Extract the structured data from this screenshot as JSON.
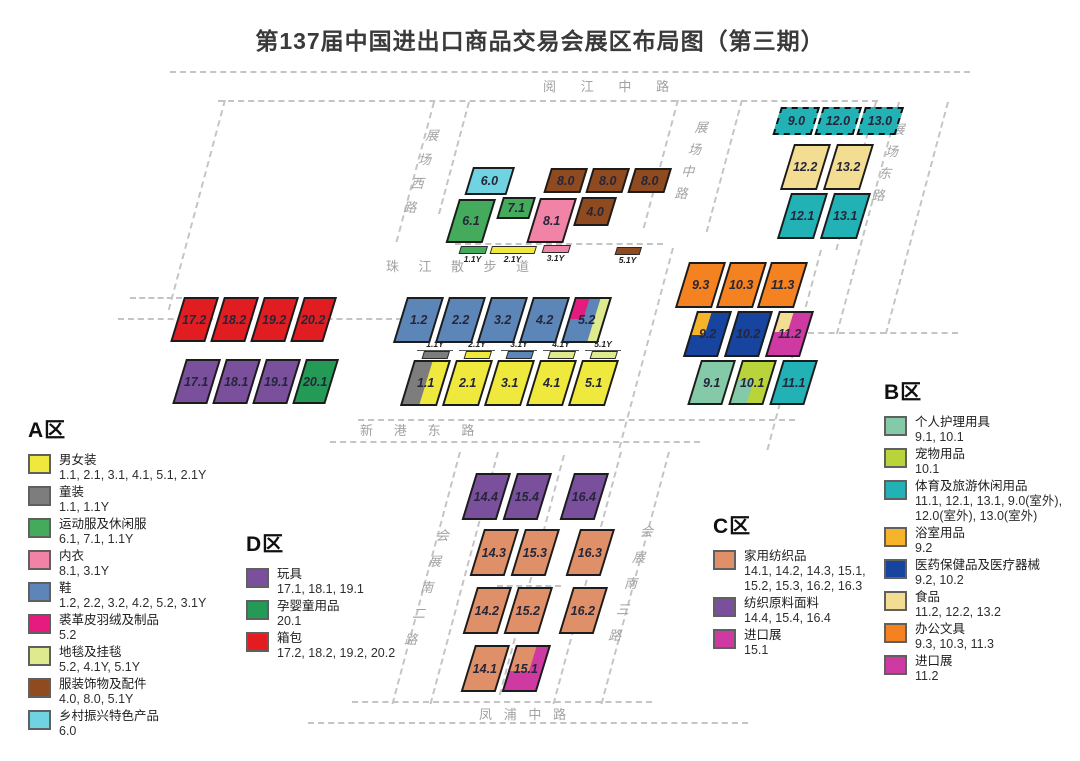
{
  "title": "第137届中国进出口商品交易会展区布局图（第三期）",
  "colors": {
    "yellow": "#efe93e",
    "gray": "#7d7d7d",
    "green": "#44ab5c",
    "pink": "#f083a6",
    "blue": "#5d86b8",
    "magentaA": "#e31c7e",
    "lightlime": "#dfe98d",
    "brown": "#8f4a1f",
    "cyan": "#6fd3e2",
    "purple": "#7a4f9c",
    "greenD": "#239a55",
    "red": "#e21d21",
    "salmon": "#df9069",
    "magentaC": "#ce3aa2",
    "mint": "#84c9a8",
    "lime": "#b9d43a",
    "teal": "#22b1b5",
    "amber": "#f6b42a",
    "navy": "#16449f",
    "cream": "#f2dd92",
    "orange": "#f58220"
  },
  "map": {
    "roads": [
      {
        "id": "yuejiang",
        "label": "阅江中路"
      },
      {
        "id": "zhanchang_xi",
        "label": "展场西路"
      },
      {
        "id": "zhanchang_zhong",
        "label": "展场中路"
      },
      {
        "id": "zhanchang_dong",
        "label": "展场东路"
      },
      {
        "id": "zhujiang",
        "label": "珠江散步道"
      },
      {
        "id": "xingang",
        "label": "新港东路"
      },
      {
        "id": "huizhan_nan_er",
        "label": "会展南二路"
      },
      {
        "id": "huizhan_nan_san",
        "label": "会展南三路"
      },
      {
        "id": "fengpu",
        "label": "凤浦中路"
      }
    ],
    "halls": [
      {
        "label": "6.0",
        "c": "cyan",
        "x": 473,
        "y": 167,
        "w": 42,
        "h": 28
      },
      {
        "label": "8.0",
        "c": "brown",
        "x": 551,
        "y": 168,
        "w": 37,
        "h": 25
      },
      {
        "label": "8.0",
        "c": "brown",
        "x": 593,
        "y": 168,
        "w": 37,
        "h": 25
      },
      {
        "label": "8.0",
        "c": "brown",
        "x": 635,
        "y": 168,
        "w": 37,
        "h": 25
      },
      {
        "label": "6.1",
        "c": "green",
        "x": 459,
        "y": 199,
        "w": 37,
        "h": 44
      },
      {
        "label": "7.1",
        "c": "green",
        "x": 503,
        "y": 197,
        "w": 33,
        "h": 22
      },
      {
        "label": "8.1",
        "c": "pink",
        "x": 540,
        "y": 198,
        "w": 37,
        "h": 45
      },
      {
        "label": "4.0",
        "c": "brown",
        "x": 582,
        "y": 197,
        "w": 35,
        "h": 29
      },
      {
        "label": "1.1Y",
        "c": "green",
        "x": 461,
        "y": 246,
        "w": 27,
        "h": 8,
        "bar": "below"
      },
      {
        "label": "2.1Y",
        "c": "yellow",
        "x": 492,
        "y": 246,
        "w": 45,
        "h": 8,
        "bar": "below"
      },
      {
        "label": "3.1Y",
        "c": "pink",
        "x": 544,
        "y": 245,
        "w": 27,
        "h": 8,
        "bar": "below"
      },
      {
        "label": "5.1Y",
        "c": "brown",
        "x": 617,
        "y": 247,
        "w": 25,
        "h": 8,
        "bar": "below"
      },
      {
        "label": "9.0",
        "c": "teal",
        "x": 781,
        "y": 107,
        "w": 39,
        "h": 28,
        "dashed": true
      },
      {
        "label": "12.0",
        "c": "teal",
        "x": 823,
        "y": 107,
        "w": 39,
        "h": 28,
        "dashed": true
      },
      {
        "label": "13.0",
        "c": "teal",
        "x": 865,
        "y": 107,
        "w": 39,
        "h": 28,
        "dashed": true
      },
      {
        "label": "12.2",
        "c": "cream",
        "x": 794,
        "y": 144,
        "w": 37,
        "h": 46
      },
      {
        "label": "13.2",
        "c": "cream",
        "x": 837,
        "y": 144,
        "w": 37,
        "h": 46
      },
      {
        "label": "12.1",
        "c": "teal",
        "x": 791,
        "y": 193,
        "w": 37,
        "h": 46
      },
      {
        "label": "13.1",
        "c": "teal",
        "x": 834,
        "y": 193,
        "w": 37,
        "h": 46
      },
      {
        "label": "17.2",
        "c": "red",
        "x": 184,
        "y": 297,
        "w": 35,
        "h": 45
      },
      {
        "label": "18.2",
        "c": "red",
        "x": 224,
        "y": 297,
        "w": 35,
        "h": 45
      },
      {
        "label": "19.2",
        "c": "red",
        "x": 264,
        "y": 297,
        "w": 35,
        "h": 45
      },
      {
        "label": "20.2",
        "c": "red",
        "x": 304,
        "y": 297,
        "w": 33,
        "h": 45
      },
      {
        "label": "17.1",
        "c": "purple",
        "x": 186,
        "y": 359,
        "w": 35,
        "h": 45
      },
      {
        "label": "18.1",
        "c": "purple",
        "x": 226,
        "y": 359,
        "w": 35,
        "h": 45
      },
      {
        "label": "19.1",
        "c": "purple",
        "x": 266,
        "y": 359,
        "w": 35,
        "h": 45
      },
      {
        "label": "20.1",
        "c": "greenD",
        "x": 306,
        "y": 359,
        "w": 33,
        "h": 45
      },
      {
        "label": "1.2",
        "c": "blue",
        "x": 407,
        "y": 297,
        "w": 37,
        "h": 46
      },
      {
        "label": "2.2",
        "c": "blue",
        "x": 449,
        "y": 297,
        "w": 37,
        "h": 46
      },
      {
        "label": "3.2",
        "c": "blue",
        "x": 491,
        "y": 297,
        "w": 37,
        "h": 46
      },
      {
        "label": "4.2",
        "c": "blue",
        "x": 533,
        "y": 297,
        "w": 37,
        "h": 46
      },
      {
        "label": "5.2",
        "c": "blue",
        "x": 575,
        "y": 297,
        "w": 37,
        "h": 46,
        "ov": [
          {
            "c": "magentaA",
            "l": 0,
            "t": 0,
            "w": 0.4,
            "h": 0.48
          },
          {
            "c": "lightlime",
            "l": 0.72,
            "t": 0,
            "w": 0.28,
            "h": 1
          }
        ]
      },
      {
        "label": "1.1Y",
        "c": "gray",
        "x": 424,
        "y": 351,
        "w": 26,
        "h": 8,
        "bar": "above"
      },
      {
        "label": "2.1Y",
        "c": "yellow",
        "x": 466,
        "y": 351,
        "w": 26,
        "h": 8,
        "bar": "above"
      },
      {
        "label": "3.1Y",
        "c": "blue",
        "x": 508,
        "y": 351,
        "w": 26,
        "h": 8,
        "bar": "above"
      },
      {
        "label": "4.1Y",
        "c": "lightlime",
        "x": 550,
        "y": 351,
        "w": 26,
        "h": 8,
        "bar": "above"
      },
      {
        "label": "5.1Y",
        "c": "lightlime",
        "x": 592,
        "y": 351,
        "w": 26,
        "h": 8,
        "bar": "above"
      },
      {
        "label": "1.1",
        "c": "gray",
        "x": 414,
        "y": 360,
        "w": 37,
        "h": 46,
        "ov": [
          {
            "c": "yellow",
            "l": 0.5,
            "t": 0,
            "w": 0.5,
            "h": 1
          }
        ]
      },
      {
        "label": "2.1",
        "c": "yellow",
        "x": 456,
        "y": 360,
        "w": 37,
        "h": 46
      },
      {
        "label": "3.1",
        "c": "yellow",
        "x": 498,
        "y": 360,
        "w": 37,
        "h": 46
      },
      {
        "label": "4.1",
        "c": "yellow",
        "x": 540,
        "y": 360,
        "w": 37,
        "h": 46
      },
      {
        "label": "5.1",
        "c": "yellow",
        "x": 582,
        "y": 360,
        "w": 37,
        "h": 46
      },
      {
        "label": "9.3",
        "c": "orange",
        "x": 689,
        "y": 262,
        "w": 37,
        "h": 46
      },
      {
        "label": "10.3",
        "c": "orange",
        "x": 730,
        "y": 262,
        "w": 37,
        "h": 46
      },
      {
        "label": "11.3",
        "c": "orange",
        "x": 771,
        "y": 262,
        "w": 37,
        "h": 46
      },
      {
        "label": "9.2",
        "c": "navy",
        "x": 697,
        "y": 311,
        "w": 35,
        "h": 46,
        "ov": [
          {
            "c": "amber",
            "l": 0,
            "t": 0,
            "w": 0.42,
            "h": 0.52
          }
        ]
      },
      {
        "label": "10.2",
        "c": "navy",
        "x": 738,
        "y": 311,
        "w": 35,
        "h": 46
      },
      {
        "label": "11.2",
        "c": "magentaC",
        "x": 779,
        "y": 311,
        "w": 35,
        "h": 46,
        "ov": [
          {
            "c": "cream",
            "l": 0,
            "t": 0,
            "w": 0.42,
            "h": 0.46
          }
        ]
      },
      {
        "label": "9.1",
        "c": "mint",
        "x": 701,
        "y": 360,
        "w": 35,
        "h": 45
      },
      {
        "label": "10.1",
        "c": "lime",
        "x": 742,
        "y": 360,
        "w": 35,
        "h": 45,
        "ov": [
          {
            "c": "mint",
            "l": 0,
            "t": 0.45,
            "w": 0.5,
            "h": 0.55
          }
        ]
      },
      {
        "label": "11.1",
        "c": "teal",
        "x": 783,
        "y": 360,
        "w": 35,
        "h": 45
      },
      {
        "label": "14.4",
        "c": "purple",
        "x": 476,
        "y": 473,
        "w": 35,
        "h": 47
      },
      {
        "label": "15.4",
        "c": "purple",
        "x": 517,
        "y": 473,
        "w": 35,
        "h": 47
      },
      {
        "label": "16.4",
        "c": "purple",
        "x": 574,
        "y": 473,
        "w": 35,
        "h": 47
      },
      {
        "label": "14.3",
        "c": "salmon",
        "x": 484,
        "y": 529,
        "w": 35,
        "h": 47
      },
      {
        "label": "15.3",
        "c": "salmon",
        "x": 525,
        "y": 529,
        "w": 35,
        "h": 47
      },
      {
        "label": "16.3",
        "c": "salmon",
        "x": 580,
        "y": 529,
        "w": 35,
        "h": 47
      },
      {
        "label": "14.2",
        "c": "salmon",
        "x": 477,
        "y": 587,
        "w": 35,
        "h": 47
      },
      {
        "label": "15.2",
        "c": "salmon",
        "x": 518,
        "y": 587,
        "w": 35,
        "h": 47
      },
      {
        "label": "16.2",
        "c": "salmon",
        "x": 573,
        "y": 587,
        "w": 35,
        "h": 47
      },
      {
        "label": "14.1",
        "c": "salmon",
        "x": 475,
        "y": 645,
        "w": 35,
        "h": 47
      },
      {
        "label": "15.1",
        "c": "magentaC",
        "x": 516,
        "y": 645,
        "w": 35,
        "h": 47,
        "ov": [
          {
            "c": "salmon",
            "l": 0,
            "t": 0,
            "w": 0.62,
            "h": 0.55
          }
        ]
      }
    ]
  },
  "legend_zones": [
    {
      "id": "A",
      "title": "A区",
      "items": [
        {
          "name": "男女装",
          "codes": "1.1, 2.1, 3.1, 4.1, 5.1, 2.1Y",
          "c": "yellow"
        },
        {
          "name": "童装",
          "codes": "1.1, 1.1Y",
          "c": "gray"
        },
        {
          "name": "运动服及休闲服",
          "codes": "6.1, 7.1, 1.1Y",
          "c": "green"
        },
        {
          "name": "内衣",
          "codes": "8.1, 3.1Y",
          "c": "pink"
        },
        {
          "name": "鞋",
          "codes": "1.2, 2.2, 3.2, 4.2, 5.2, 3.1Y",
          "c": "blue"
        },
        {
          "name": "裘革皮羽绒及制品",
          "codes": "5.2",
          "c": "magentaA"
        },
        {
          "name": "地毯及挂毯",
          "codes": "5.2, 4.1Y, 5.1Y",
          "c": "lightlime"
        },
        {
          "name": "服装饰物及配件",
          "codes": "4.0, 8.0, 5.1Y",
          "c": "brown"
        },
        {
          "name": "乡村振兴特色产品",
          "codes": "6.0",
          "c": "cyan"
        }
      ]
    },
    {
      "id": "D",
      "title": "D区",
      "items": [
        {
          "name": "玩具",
          "codes": "17.1, 18.1, 19.1",
          "c": "purple"
        },
        {
          "name": "孕婴童用品",
          "codes": "20.1",
          "c": "greenD"
        },
        {
          "name": "箱包",
          "codes": "17.2, 18.2, 19.2, 20.2",
          "c": "red"
        }
      ]
    },
    {
      "id": "C",
      "title": "C区",
      "items": [
        {
          "name": "家用纺织品",
          "codes": "14.1, 14.2, 14.3, 15.1, 15.2, 15.3, 16.2, 16.3",
          "c": "salmon"
        },
        {
          "name": "纺织原料面料",
          "codes": "14.4, 15.4, 16.4",
          "c": "purple"
        },
        {
          "name": "进口展",
          "codes": "15.1",
          "c": "magentaC"
        }
      ]
    },
    {
      "id": "B",
      "title": "B区",
      "items": [
        {
          "name": "个人护理用具",
          "codes": "9.1, 10.1",
          "c": "mint"
        },
        {
          "name": "宠物用品",
          "codes": "10.1",
          "c": "lime"
        },
        {
          "name": "体育及旅游休闲用品",
          "codes": "11.1, 12.1, 13.1, 9.0(室外), 12.0(室外), 13.0(室外)",
          "c": "teal"
        },
        {
          "name": "浴室用品",
          "codes": "9.2",
          "c": "amber"
        },
        {
          "name": "医药保健品及医疗器械",
          "codes": "9.2, 10.2",
          "c": "navy"
        },
        {
          "name": "食品",
          "codes": "11.2, 12.2, 13.2",
          "c": "cream"
        },
        {
          "name": "办公文具",
          "codes": "9.3, 10.3, 11.3",
          "c": "orange"
        },
        {
          "name": "进口展",
          "codes": "11.2",
          "c": "magentaC"
        }
      ]
    }
  ]
}
